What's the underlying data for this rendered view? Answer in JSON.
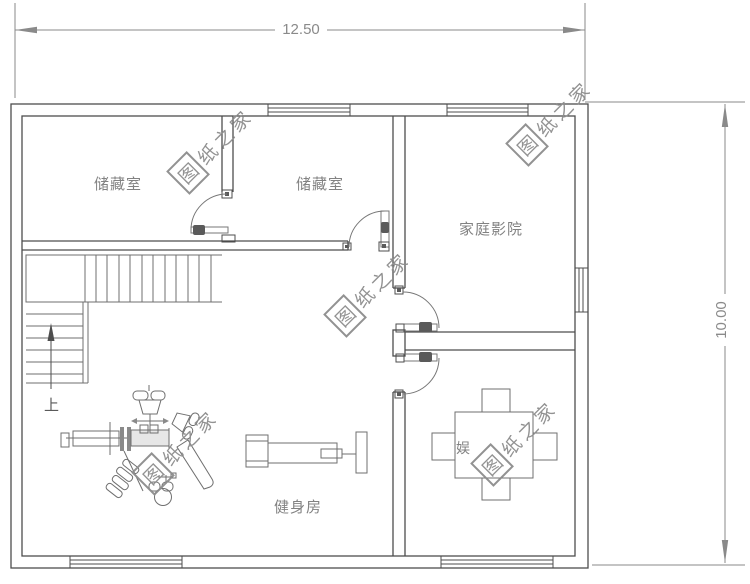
{
  "colors": {
    "wall": "#4d4d4d",
    "furniture": "#6f6f6f",
    "dimension": "#8a8a8a",
    "watermark": "#8d8d8d",
    "label": "#828282",
    "door": "#777777",
    "bg": "#ffffff"
  },
  "dimensions": {
    "width_label": "12.50",
    "height_label": "10.00"
  },
  "rooms": {
    "storage_left": "储藏室",
    "storage_right": "储藏室",
    "home_theater": "家庭影院",
    "gym": "健身房",
    "entertainment_visible_char": "娱"
  },
  "stairs": {
    "up_label": "上"
  },
  "watermark": {
    "boxed_char": "图",
    "tail_text": "纸之家",
    "full_text": "图纸之家"
  }
}
